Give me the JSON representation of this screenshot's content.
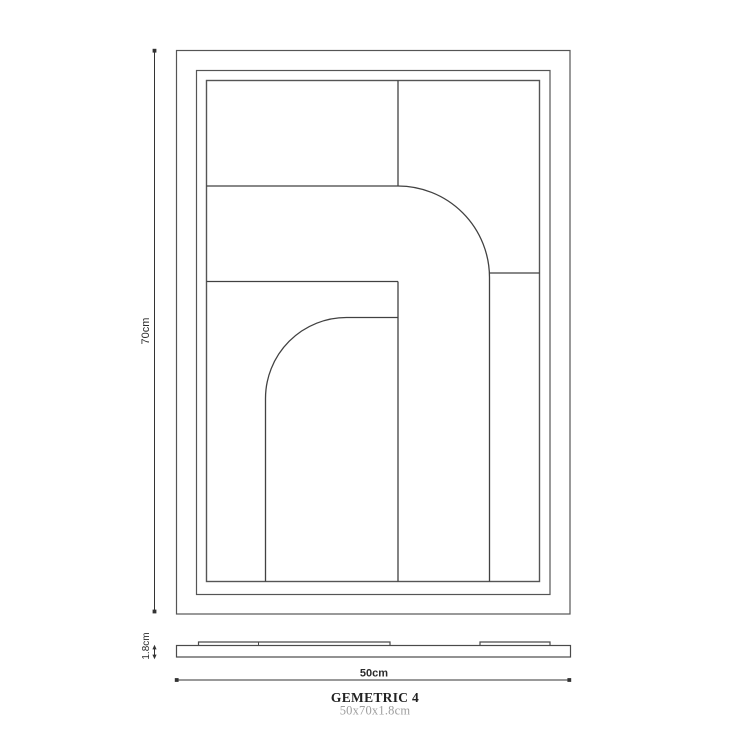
{
  "labels": {
    "height": "70cm",
    "width": "50cm",
    "depth": "1.8cm"
  },
  "caption": {
    "title": "GEMETRIC 4",
    "size": "50x70x1.8cm"
  },
  "colors": {
    "background": "#ffffff",
    "frame_line": "#555555",
    "art_line": "#414141",
    "side_line": "#4a4a4a",
    "dimension_line": "#333333",
    "label_text": "#2b2b2b",
    "title_text": "#222222",
    "size_text": "#9e9e9e"
  }
}
